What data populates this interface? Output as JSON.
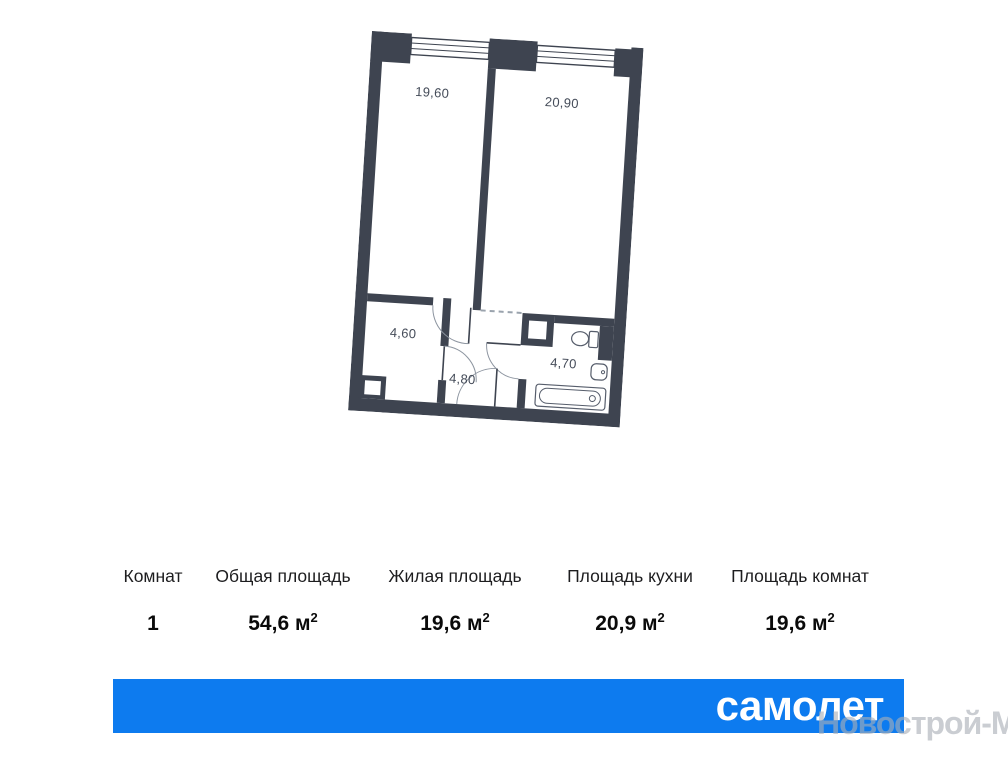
{
  "plan": {
    "wall_color": "#3e4450",
    "labels": {
      "room_living": "19,60",
      "room_kitchen": "20,90",
      "room_small": "4,60",
      "hallway": "4,80",
      "bathroom": "4,70"
    }
  },
  "specs": {
    "columns": [
      {
        "label": "Комнат",
        "value": "1",
        "unit": "",
        "sup": ""
      },
      {
        "label": "Общая площадь",
        "value": "54,6",
        "unit": " м",
        "sup": "2"
      },
      {
        "label": "Жилая площадь",
        "value": "19,6",
        "unit": " м",
        "sup": "2"
      },
      {
        "label": "Площадь кухни",
        "value": "20,9",
        "unit": " м",
        "sup": "2"
      },
      {
        "label": "Площадь комнат",
        "value": "19,6",
        "unit": " м",
        "sup": "2"
      }
    ]
  },
  "banner": {
    "brand": "самолет",
    "color": "#0d7bef"
  },
  "watermark": {
    "text": "Новострой-М"
  }
}
